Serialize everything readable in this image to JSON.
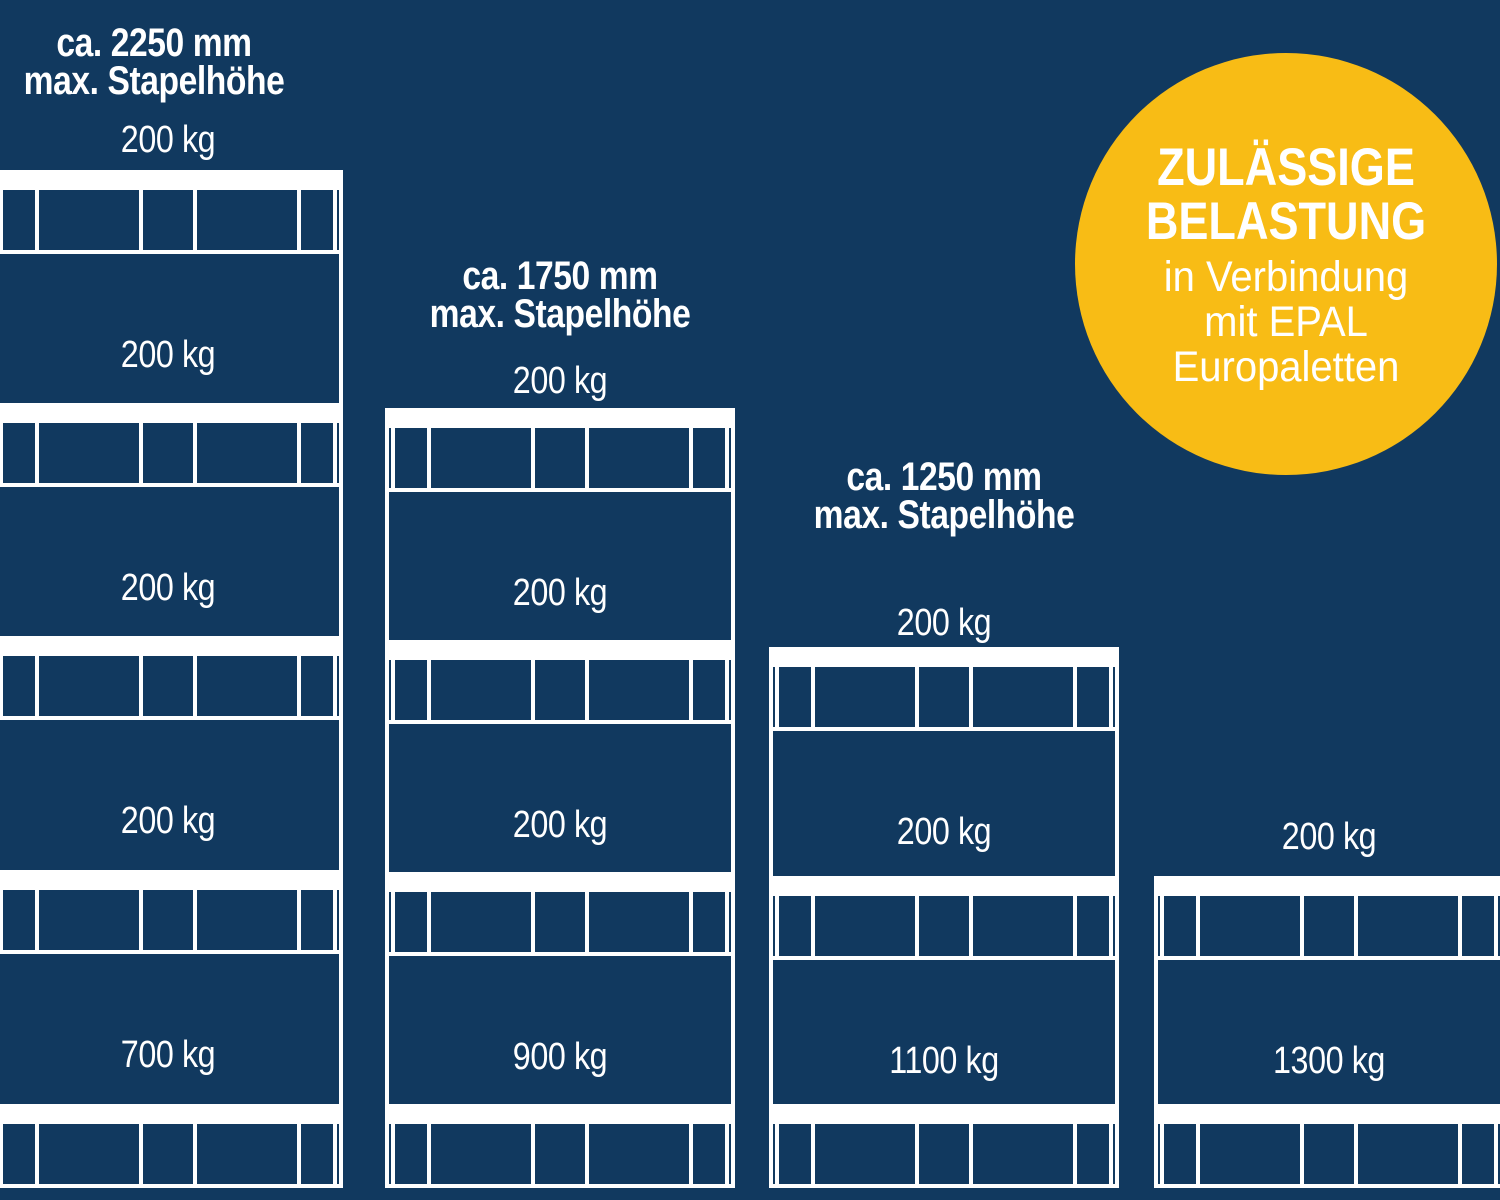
{
  "badge": {
    "title_line1": "ZULÄSSIGE",
    "title_line2": "BELASTUNG",
    "subtitle_line1": "in Verbindung",
    "subtitle_line2": "mit EPAL",
    "subtitle_line3": "Europaletten"
  },
  "stacks": [
    {
      "title_line1": "ca. 2250 mm",
      "title_line2": "max. Stapelhöhe",
      "top_load": "200 kg",
      "loads": [
        "200 kg",
        "200 kg",
        "200 kg",
        "700 kg"
      ],
      "pallet_count": 5
    },
    {
      "title_line1": "ca. 1750 mm",
      "title_line2": "max. Stapelhöhe",
      "top_load": "200 kg",
      "loads": [
        "200 kg",
        "200 kg",
        "900 kg"
      ],
      "pallet_count": 4
    },
    {
      "title_line1": "ca. 1250 mm",
      "title_line2": "max. Stapelhöhe",
      "top_load": "200 kg",
      "loads": [
        "200 kg",
        "1100 kg"
      ],
      "pallet_count": 3
    },
    {
      "top_load": "200 kg",
      "loads": [
        "1300 kg"
      ],
      "pallet_count": 2
    }
  ],
  "colors": {
    "background": "#11395F",
    "line": "#FFFFFF",
    "badge": "#F8BC15",
    "text": "#FFFFFF"
  }
}
